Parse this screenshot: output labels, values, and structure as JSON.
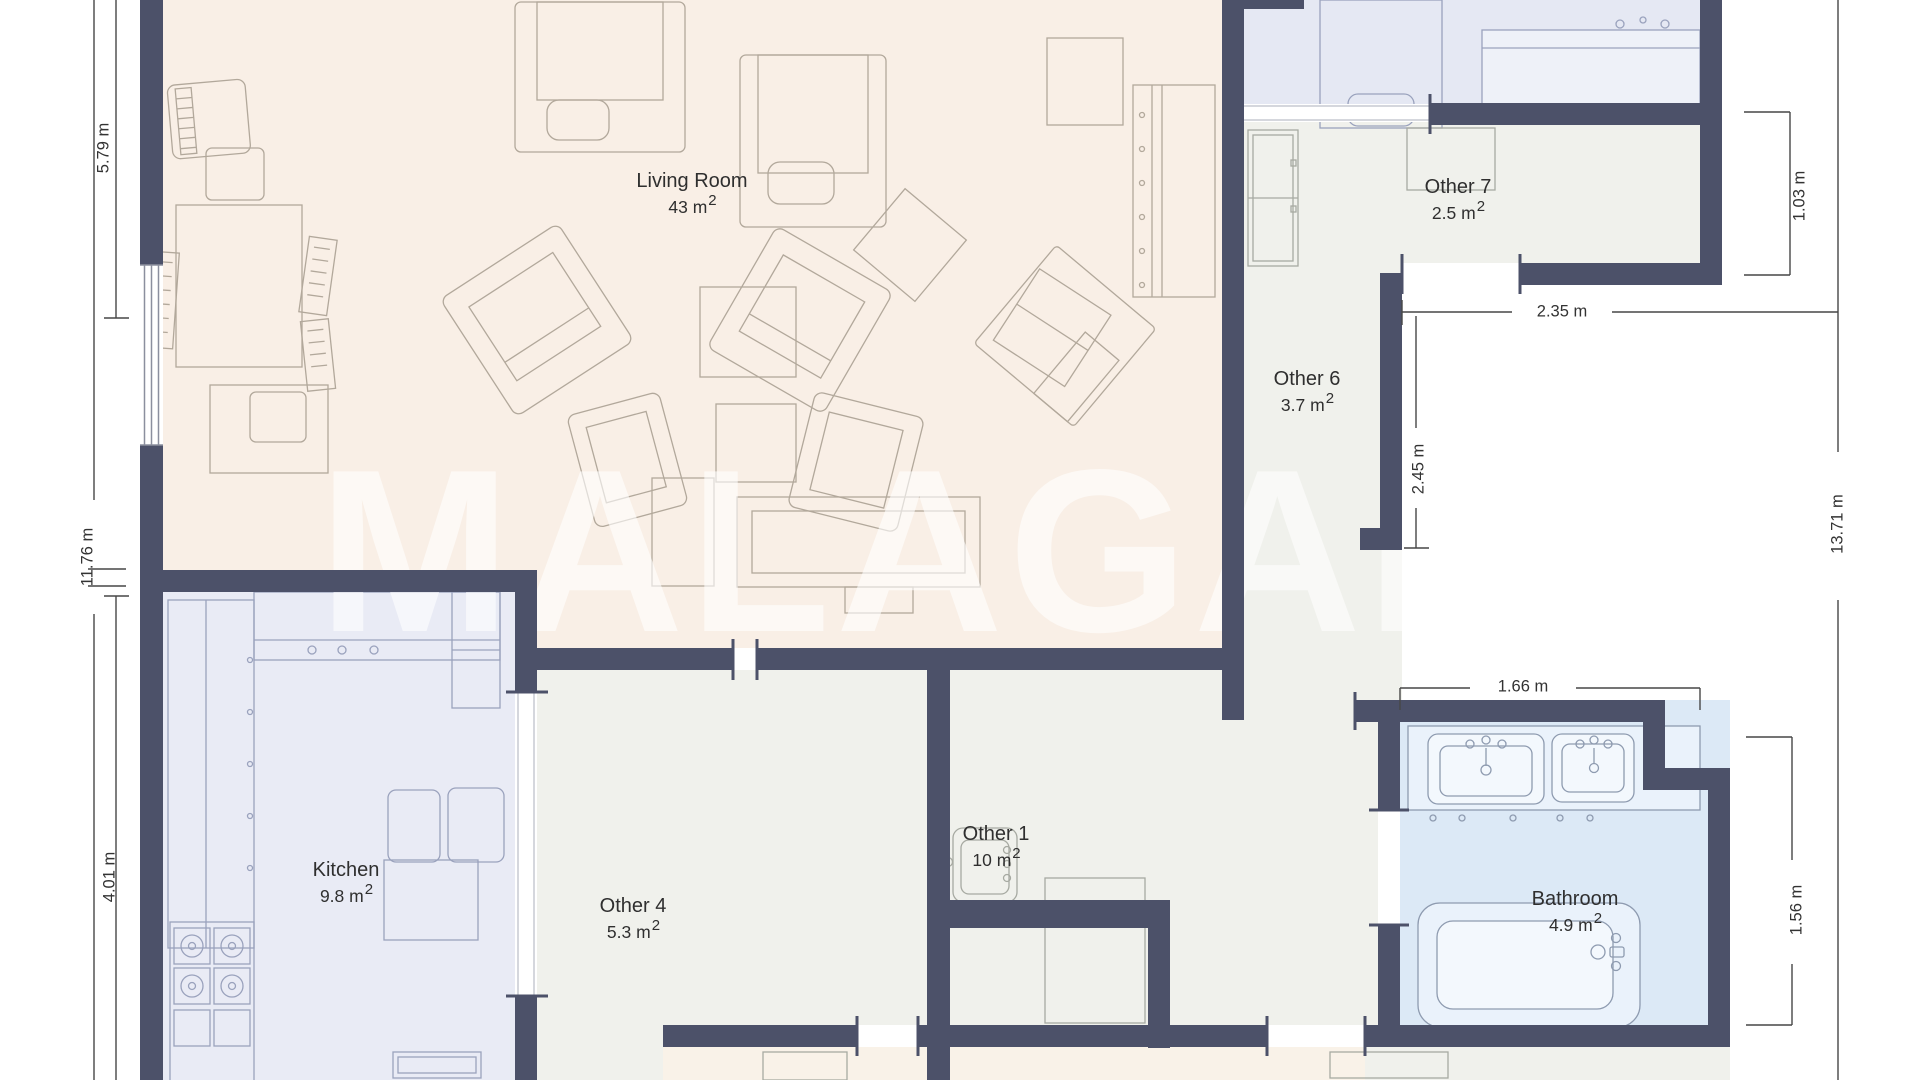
{
  "watermark": "MALAGAM",
  "area_superscript": "2",
  "rooms": {
    "living": {
      "name": "Living Room",
      "area": "43",
      "unit": "m"
    },
    "kitchen": {
      "name": "Kitchen",
      "area": "9.8",
      "unit": "m"
    },
    "other4": {
      "name": "Other 4",
      "area": "5.3",
      "unit": "m"
    },
    "other1": {
      "name": "Other 1",
      "area": "10",
      "unit": "m"
    },
    "bathroom": {
      "name": "Bathroom",
      "area": "4.9",
      "unit": "m"
    },
    "other6": {
      "name": "Other 6",
      "area": "3.7",
      "unit": "m"
    },
    "other7": {
      "name": "Other 7",
      "area": "2.5",
      "unit": "m"
    }
  },
  "dimensions": {
    "left_top": "5.79 m",
    "left_full": "11.76 m",
    "left_bottom": "4.01 m",
    "right_full": "13.71 m",
    "right_top": "1.03 m",
    "top_right_width": "2.35 m",
    "middle_height": "2.45 m",
    "bath_width": "1.66 m",
    "bath_height": "1.56 m"
  },
  "colors": {
    "wall": "#4c5169",
    "living_floor": "#f9efe6",
    "kitchen_floor": "#e9ebf5",
    "gray_floor": "#f0f1ec",
    "bathroom_floor": "#dce9f6",
    "blue_room_floor": "#e5e8f3",
    "bottom_rooms_floor": "#f9f2e8"
  }
}
